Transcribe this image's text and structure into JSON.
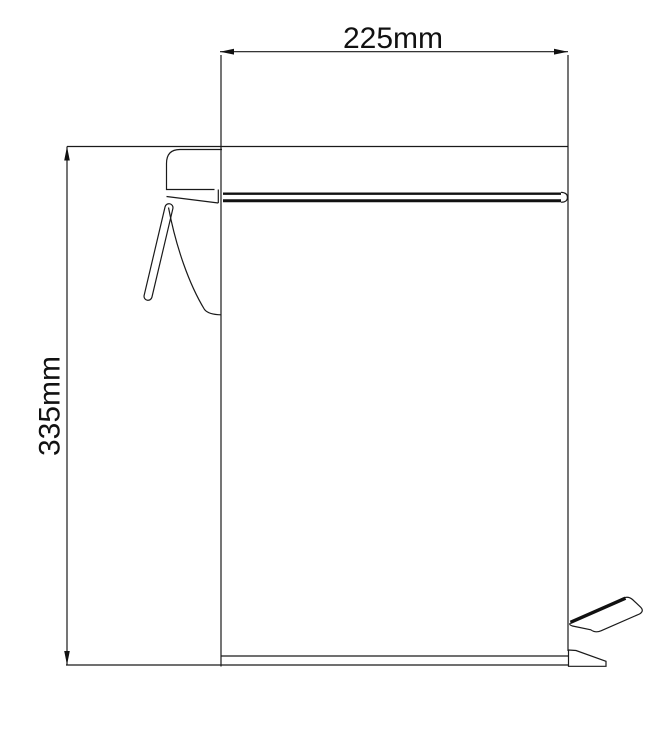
{
  "drawing": {
    "type": "technical-line-drawing",
    "subject": "pedal-bin-side-view",
    "width_dim": {
      "label": "225mm",
      "value_mm": 225
    },
    "height_dim": {
      "label": "335mm",
      "value_mm": 335
    },
    "colors": {
      "line": "#1a1a1a",
      "background": "#ffffff"
    }
  }
}
